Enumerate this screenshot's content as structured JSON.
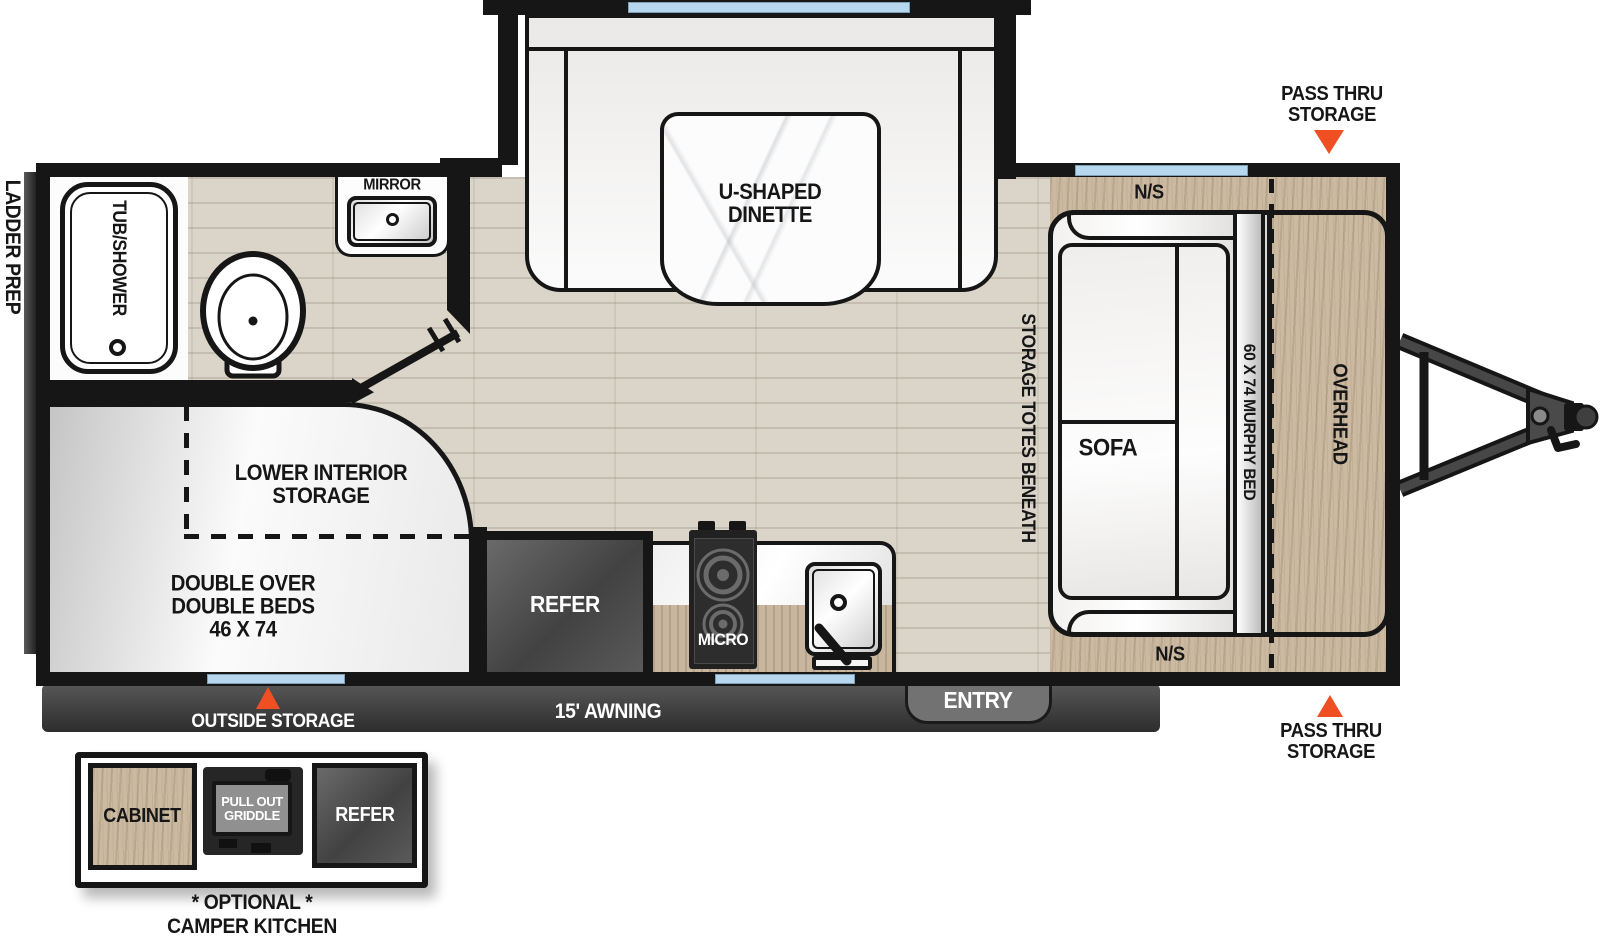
{
  "colors": {
    "accent_orange": "#F04F24",
    "wall_black": "#161616",
    "window_blue": "#B7D7EE",
    "wood_tan": "#CBBAA1",
    "floor_beige": "#DBD5C9",
    "dark_gray": "#3E3E3E"
  },
  "exterior": {
    "ladder_prep": "LADDER PREP",
    "pass_thru_top": {
      "line1": "PASS THRU",
      "line2": "STORAGE"
    },
    "pass_thru_bottom": {
      "line1": "PASS THRU",
      "line2": "STORAGE"
    },
    "outside_storage": "OUTSIDE STORAGE",
    "awning": "15' AWNING",
    "entry": "ENTRY"
  },
  "bathroom": {
    "tub": "TUB/SHOWER",
    "mirror": "MIRROR"
  },
  "dinette": {
    "line1": "U-SHAPED",
    "line2": "DINETTE"
  },
  "bedroom": {
    "ns_top": "N/S",
    "ns_bottom": "N/S",
    "sofa": "SOFA",
    "murphy_bed": "60 X 74 MURPHY BED",
    "overhead": "OVERHEAD",
    "storage_totes": "STORAGE TOTES BENEATH"
  },
  "bunk": {
    "storage_line1": "LOWER INTERIOR",
    "storage_line2": "STORAGE",
    "bed_line1": "DOUBLE OVER",
    "bed_line2": "DOUBLE BEDS",
    "bed_line3": "46 X 74"
  },
  "kitchen": {
    "refer": "REFER",
    "micro": "MICRO"
  },
  "camper_kitchen": {
    "cabinet": "CABINET",
    "griddle_line1": "PULL OUT",
    "griddle_line2": "GRIDDLE",
    "refer": "REFER",
    "optional": "* OPTIONAL *",
    "title": "CAMPER KITCHEN"
  }
}
